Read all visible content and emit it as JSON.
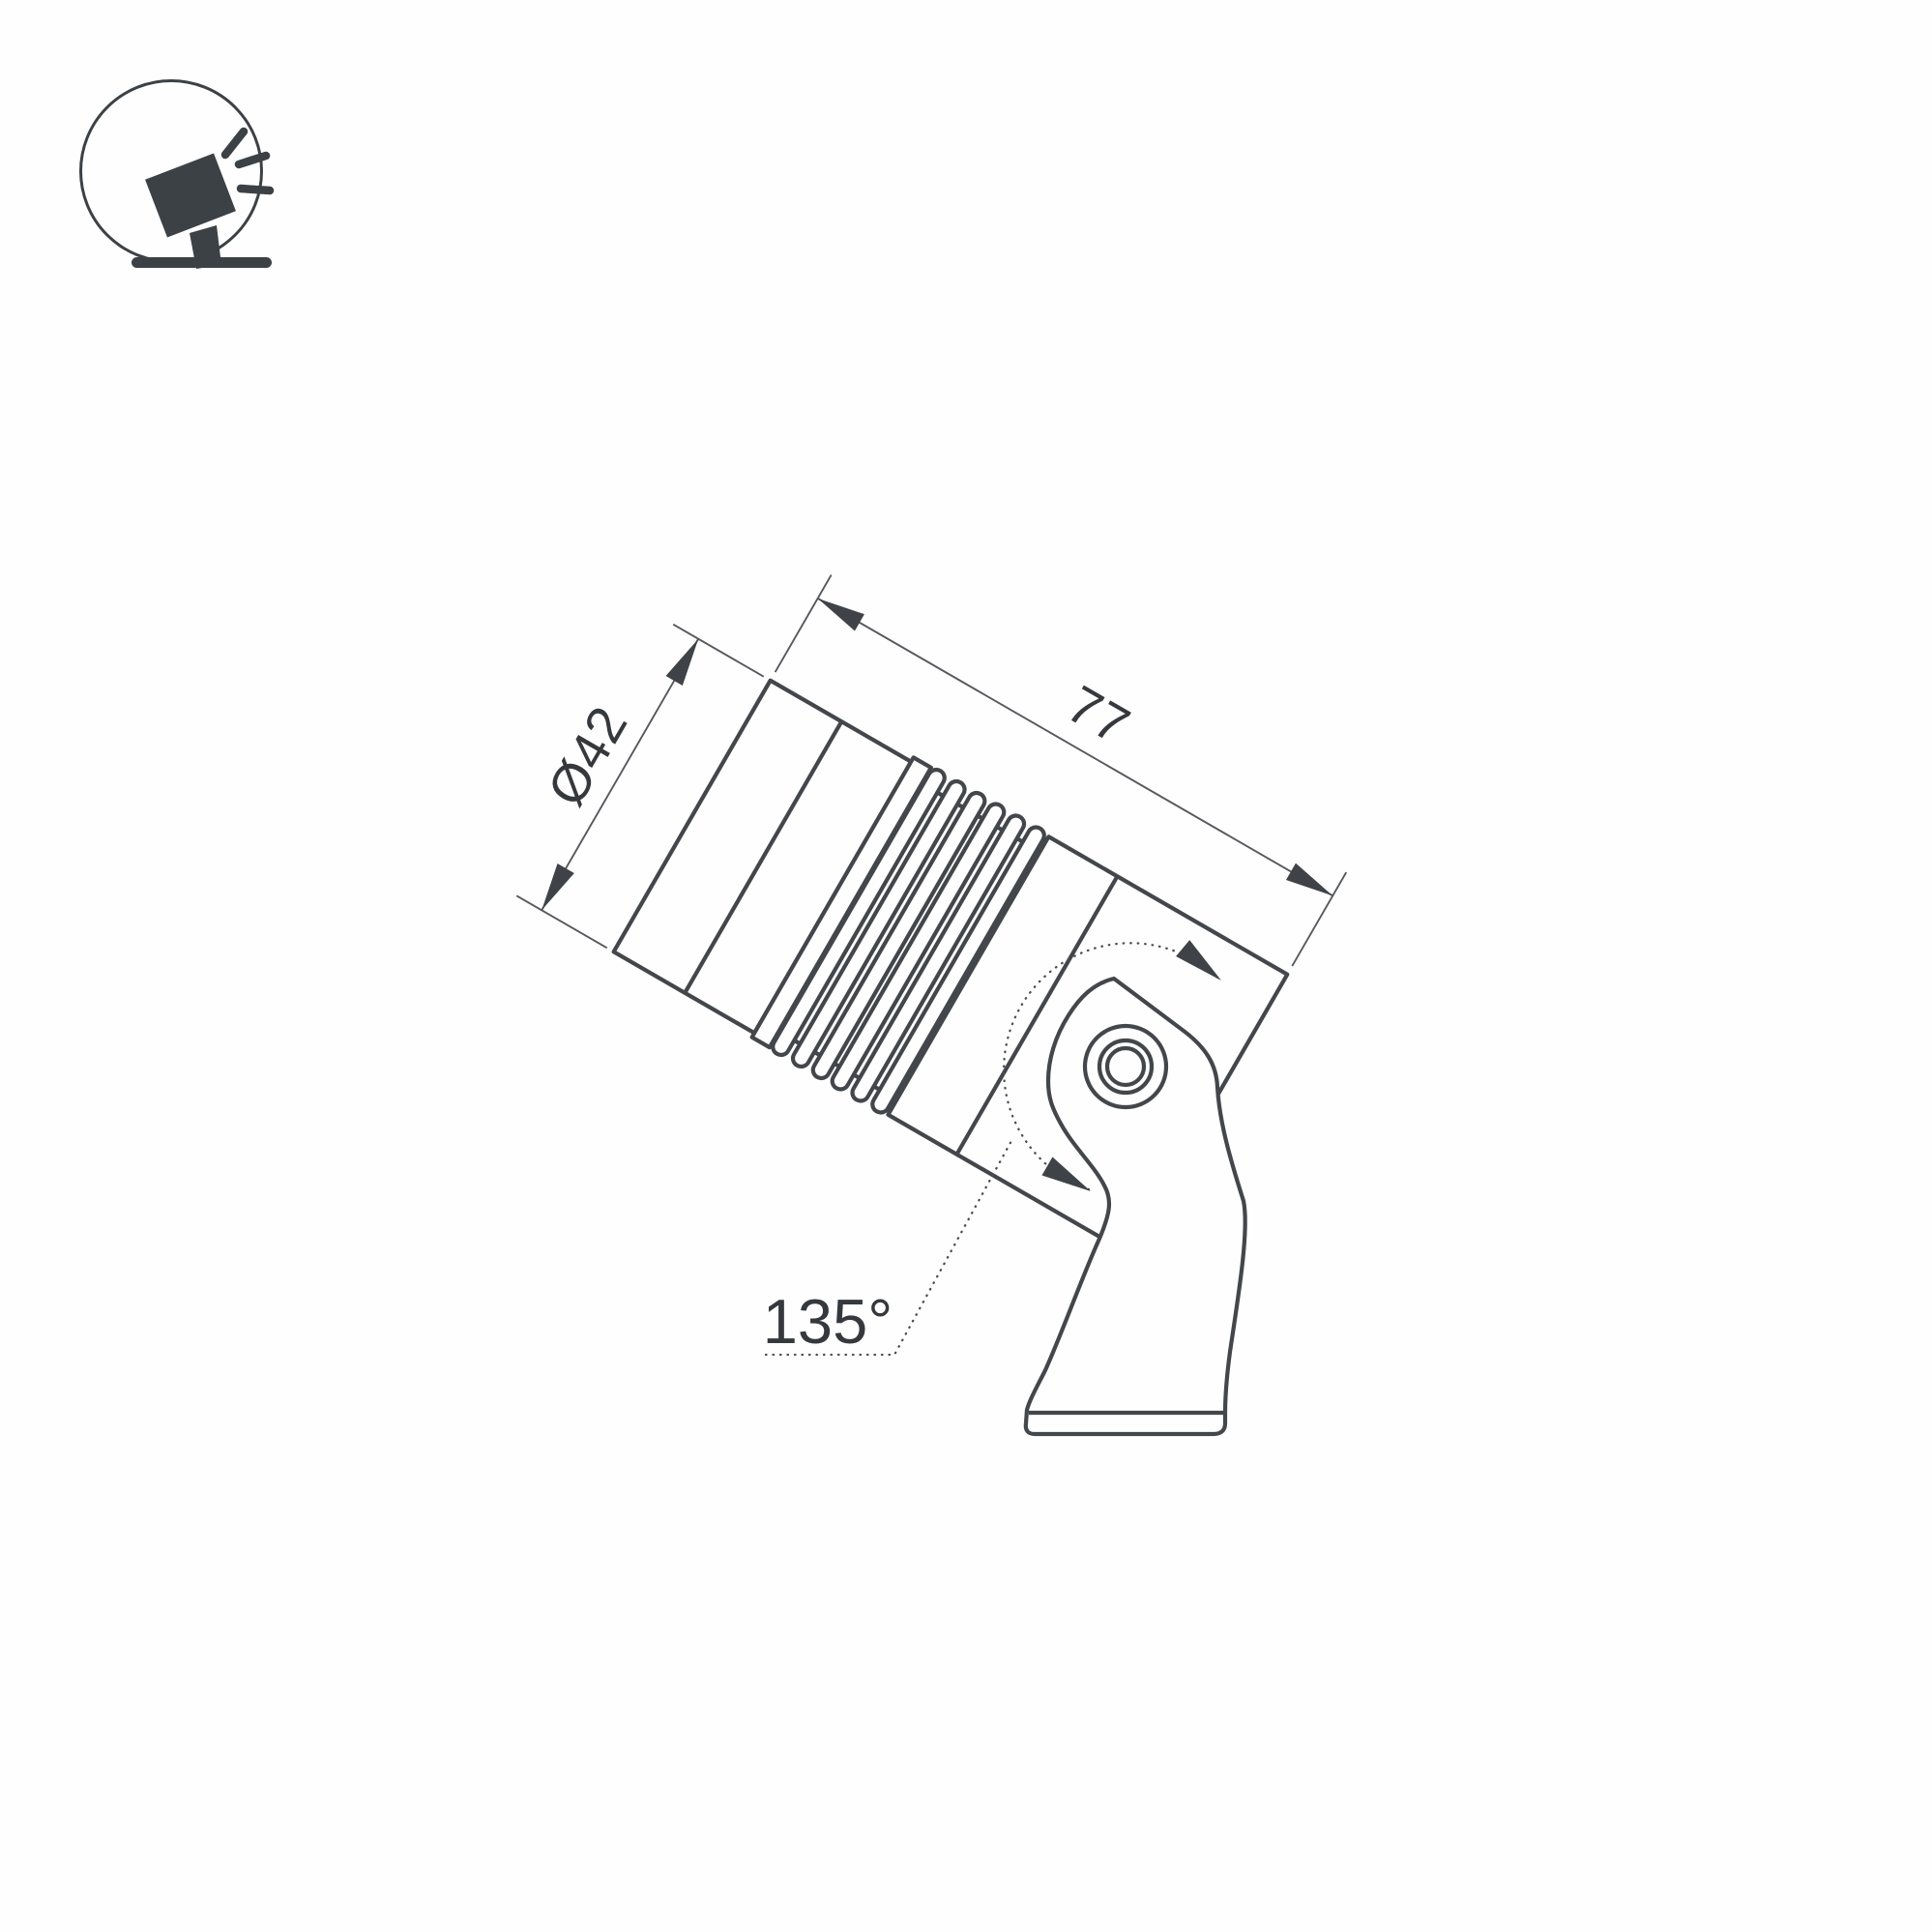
{
  "page": {
    "title": "Spotlight technical dimension drawing",
    "background": "#fefefe"
  },
  "icon": {
    "name": "tilted-spotlight-on-stand",
    "color": "#3c4145"
  },
  "drawing": {
    "product": "swivel spotlight luminaire side view",
    "diameter": {
      "label": "Ø42"
    },
    "length": {
      "label": "77"
    },
    "swivel_angle": {
      "label": "135°"
    },
    "colors": {
      "outline": "#43474b",
      "thin_line": "#55585c",
      "ink": "#35393d"
    }
  }
}
